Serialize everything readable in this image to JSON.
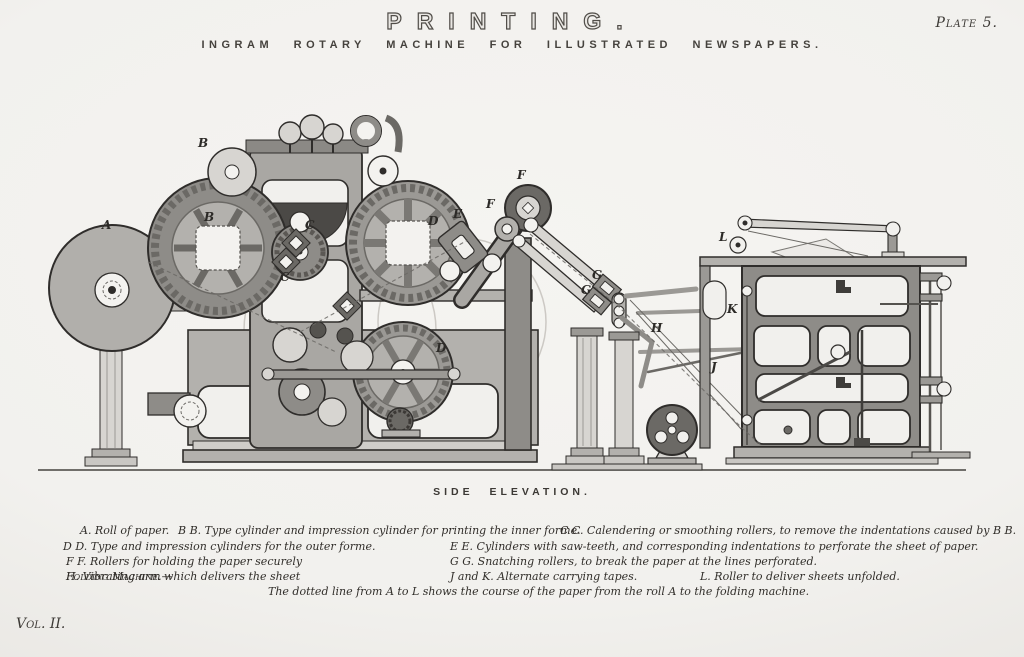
{
  "header": {
    "title": "PRINTING.",
    "plate": "Plate 5.",
    "subtitle": "INGRAM ROTARY MACHINE FOR ILLUSTRATED NEWSPAPERS."
  },
  "figure": {
    "type": "engraved side-elevation of printing machine",
    "caption": "SIDE ELEVATION.",
    "labels": [
      "A",
      "B",
      "B",
      "C",
      "C",
      "D",
      "D",
      "E",
      "F",
      "F",
      "G",
      "G",
      "H",
      "J",
      "K",
      "L"
    ]
  },
  "legend": {
    "lines": [
      [
        "A. Roll of paper.",
        "B B. Type cylinder and impression cylinder for printing the inner forme.",
        "C C. Calendering or smoothing rollers, to remove the indentations caused by B B."
      ],
      [
        "D D. Type and impression cylinders for the outer forme.",
        "E E. Cylinders with saw-teeth, and corresponding indentations to perforate the sheet of paper."
      ],
      [
        "F F. Rollers for holding the paper securely",
        "G G. Snatching rollers, to break the paper at the lines perforated."
      ],
      [
        "Folding Machine.—",
        "H. Vibrating arm which delivers the sheet",
        "J and K. Alternate carrying tapes.",
        "L. Roller to deliver sheets unfolded."
      ]
    ],
    "note": "The dotted line from A to L shows the course of the paper from the roll A to the folding machine."
  },
  "footer": {
    "volume": "Vol. II."
  },
  "colors": {
    "paper": "#f3f2ef",
    "ink": "#2f2d2b",
    "metal_mid": "#b3b1ad",
    "metal_dark": "#8e8c88"
  }
}
